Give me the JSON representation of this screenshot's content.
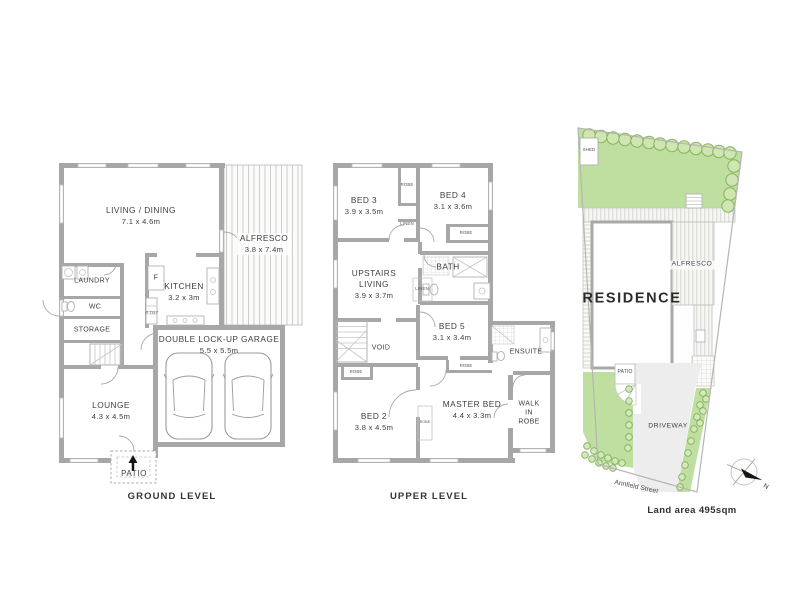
{
  "palette": {
    "wall_gray": "#a7a7a7",
    "lawn_green": "#bfdfa0",
    "tree_stroke": "#82b05a",
    "driveway_gray": "#ededed",
    "text": "#3e3e3e"
  },
  "ground": {
    "title": "GROUND LEVEL",
    "living_dining": {
      "name": "LIVING / DINING",
      "dims": "7.1 x 4.6m"
    },
    "alfresco": {
      "name": "ALFRESCO",
      "dims": "3.8 x 7.4m"
    },
    "laundry": {
      "name": "LAUNDRY"
    },
    "wc": {
      "name": "WC"
    },
    "storage": {
      "name": "STORAGE"
    },
    "kitchen": {
      "name": "KITCHEN",
      "dims": "3.2 x 3m"
    },
    "fridge": {
      "name": "F"
    },
    "pantry": {
      "name": "P'TRY"
    },
    "garage": {
      "name": "DOUBLE LOCK-UP GARAGE",
      "dims": "5.5 x 5.5m"
    },
    "lounge": {
      "name": "LOUNGE",
      "dims": "4.3 x 4.5m"
    },
    "patio": {
      "name": "PATIO"
    }
  },
  "upper": {
    "title": "UPPER LEVEL",
    "bed3": {
      "name": "BED 3",
      "dims": "3.9 x 3.5m"
    },
    "bed4": {
      "name": "BED 4",
      "dims": "3.1 x 3.6m"
    },
    "bed5": {
      "name": "BED 5",
      "dims": "3.1 x 3.4m"
    },
    "bed2": {
      "name": "BED 2",
      "dims": "3.8 x 4.5m"
    },
    "master": {
      "name": "MASTER BED",
      "dims": "4.4 x 3.3m"
    },
    "upstairs_living": {
      "line1": "UPSTAIRS",
      "line2": "LIVING",
      "dims": "3.9 x 3.7m"
    },
    "bath": {
      "name": "BATH"
    },
    "ensuite": {
      "name": "ENSUITE"
    },
    "void": {
      "name": "VOID"
    },
    "walk_in_robe": {
      "line1": "WALK",
      "line2": "IN",
      "line3": "ROBE"
    },
    "robe_top": {
      "name": "ROBE"
    },
    "linen_top": {
      "name": "LINEN"
    },
    "robe_bed4": {
      "name": "ROBE"
    },
    "linen_mid": {
      "name": "LINEN"
    },
    "robe_hall": {
      "name": "ROBE"
    },
    "robe_bed5": {
      "name": "ROBE"
    },
    "robe_master": {
      "name": "ROBE"
    }
  },
  "site": {
    "shed": "SHED",
    "residence": "RESIDENCE",
    "alfresco": "ALFRESCO",
    "patio": "PATIO",
    "driveway": "DRIVEWAY",
    "street": "Annfield Street",
    "land_area": "Land area 495sqm",
    "compass_north": "N"
  }
}
